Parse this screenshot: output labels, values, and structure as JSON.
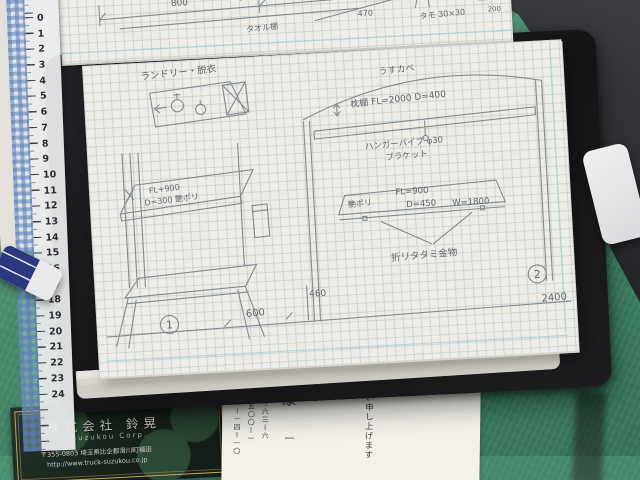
{
  "scene": {
    "mat_color": "#4e8f71",
    "binder_color": "#1b1b1e",
    "pencil_color": "#7e8287",
    "grid_line_color": "#a5c0c4"
  },
  "ruler": {
    "numbers": [
      "0",
      "1",
      "2",
      "3",
      "4",
      "5",
      "6",
      "7",
      "8",
      "9",
      "10",
      "11",
      "12",
      "13",
      "14",
      "15",
      "16",
      "17",
      "18",
      "19",
      "20",
      "21",
      "22",
      "23",
      "24"
    ]
  },
  "top_page": {
    "dim_800": "800",
    "dim_400": "400",
    "dim_470": "470",
    "dim_200": "200",
    "note_shelf": "タオル棚",
    "note_wood": "タモ 30×30"
  },
  "main_page": {
    "laundry_label": "ランドリー・脱衣",
    "stand": {
      "dim1": "FL+900",
      "dim2": "D=300 艶ポリ",
      "circle": "1"
    },
    "dims": {
      "d600": "600",
      "d460": "460",
      "d2400": "2400"
    },
    "closet": {
      "wall_label": "うすカベ",
      "shelf_label": "枕棚 FL=2000 D=400",
      "pipe_note1": "ハンガーパイプ φ30",
      "pipe_note2": "ブラケット",
      "counter_material": "艶ポリ",
      "counter_fl": "FL=900",
      "counter_d": "D=450",
      "counter_w": "W=1800",
      "folding_note": "折リタタミ金物",
      "circle": "2"
    }
  },
  "business_card": {
    "company": "株式会社 鈴晃",
    "company_en": "Suzukou Corp.",
    "address": "〒355-0803 埼玉県比企郡滑川町福田",
    "url": "http://www.truck-suzukou.co.jp"
  },
  "letter": {
    "col_greeting": "い申し上げます",
    "col_shi": "シ",
    "col_kou": "康",
    "col_one": "一",
    "col_num1": "田下六三ー六",
    "col_num2": "二五〇〇ー一",
    "col_num3": "〇一ー一四ー一〇"
  }
}
